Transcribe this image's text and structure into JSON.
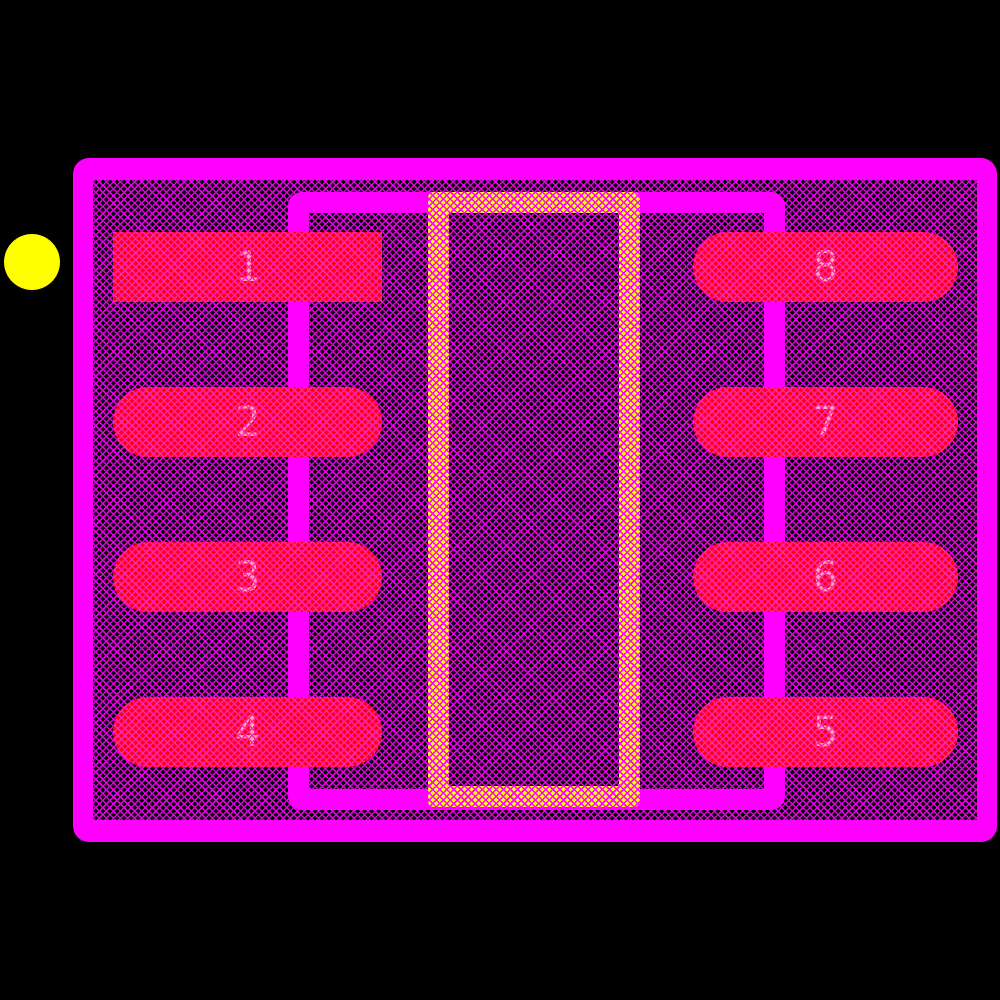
{
  "colors": {
    "outline": "#FF00FF",
    "hatch_on_black": "#E000E0",
    "pad_base": "#FF0012",
    "pad_hatch": "#FF24AC",
    "thermal_base": "#FFFF00",
    "thermal_hatch": "#FF00FF",
    "pin1_marker": "#FFFF00",
    "pad_number_text": "#FFB9C4"
  },
  "pads": [
    {
      "number": "1",
      "side": "left",
      "shape": "rectangle"
    },
    {
      "number": "2",
      "side": "left",
      "shape": "stadium"
    },
    {
      "number": "3",
      "side": "left",
      "shape": "stadium"
    },
    {
      "number": "4",
      "side": "left",
      "shape": "stadium"
    },
    {
      "number": "5",
      "side": "right",
      "shape": "stadium"
    },
    {
      "number": "6",
      "side": "right",
      "shape": "stadium"
    },
    {
      "number": "7",
      "side": "right",
      "shape": "stadium"
    },
    {
      "number": "8",
      "side": "right",
      "shape": "stadium"
    }
  ],
  "markers": {
    "pin1_indicator": "yellow-circle"
  }
}
